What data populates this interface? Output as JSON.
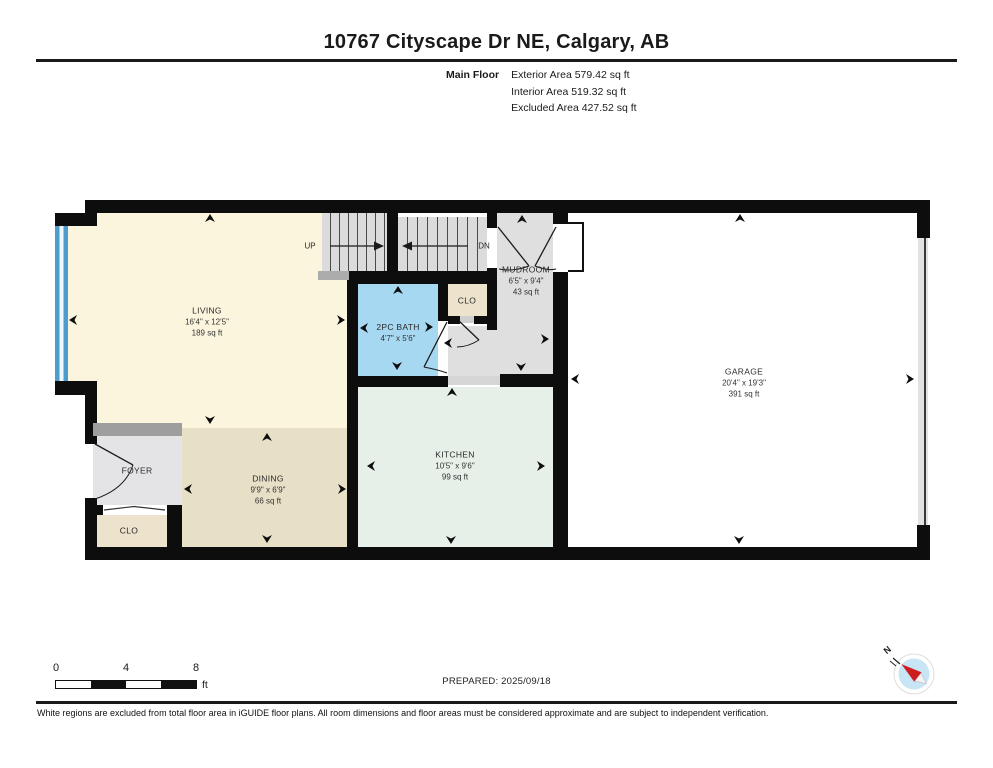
{
  "header": {
    "title": "10767 Cityscape Dr NE, Calgary, AB",
    "floor_label": "Main Floor",
    "area_lines": {
      "exterior": "Exterior Area 579.42 sq ft",
      "interior": "Interior Area 519.32 sq ft",
      "excluded": "Excluded Area 427.52 sq ft"
    }
  },
  "plan": {
    "rooms": {
      "living": {
        "name": "LIVING",
        "dims": "16'4\" x 12'5\"",
        "area": "189 sq ft"
      },
      "dining": {
        "name": "DINING",
        "dims": "9'9\" x 6'9\"",
        "area": "66 sq ft"
      },
      "foyer": {
        "name": "FOYER"
      },
      "foyer_closet": {
        "name": "CLO"
      },
      "bath": {
        "name": "2PC BATH",
        "dims": "4'7\" x 5'6\""
      },
      "hall_closet": {
        "name": "CLO"
      },
      "mudroom": {
        "name": "MUDROOM",
        "dims": "6'5\" x 9'4\"",
        "area": "43 sq ft"
      },
      "kitchen": {
        "name": "KITCHEN",
        "dims": "10'5\" x 9'6\"",
        "area": "99 sq ft"
      },
      "garage": {
        "name": "GARAGE",
        "dims": "20'4\" x 19'3\"",
        "area": "391 sq ft"
      }
    },
    "stairs": {
      "up_label": "UP",
      "down_label": "DN"
    },
    "colors": {
      "living": "#FBF5DE",
      "dining": "#E8DFC7",
      "foyer": "#E4E4E6",
      "closet": "#EDE2CC",
      "bath": "#A6D8F2",
      "mudroom": "#DFDFDF",
      "kitchen": "#E6F0E8",
      "garage": "#FFFFFF",
      "stairs": "#DCDCDC",
      "window": "#4E9CCB",
      "wall": "#0D0D0D"
    }
  },
  "footer": {
    "scale_ticks": {
      "start": "0",
      "mid": "4",
      "end": "8"
    },
    "scale_unit": "ft",
    "prepared": "PREPARED: 2025/09/18",
    "compass_north_label": "N",
    "disclaimer": "White regions are excluded from total floor area in iGUIDE floor plans. All room dimensions and floor areas must be considered approximate and are subject to independent verification."
  }
}
